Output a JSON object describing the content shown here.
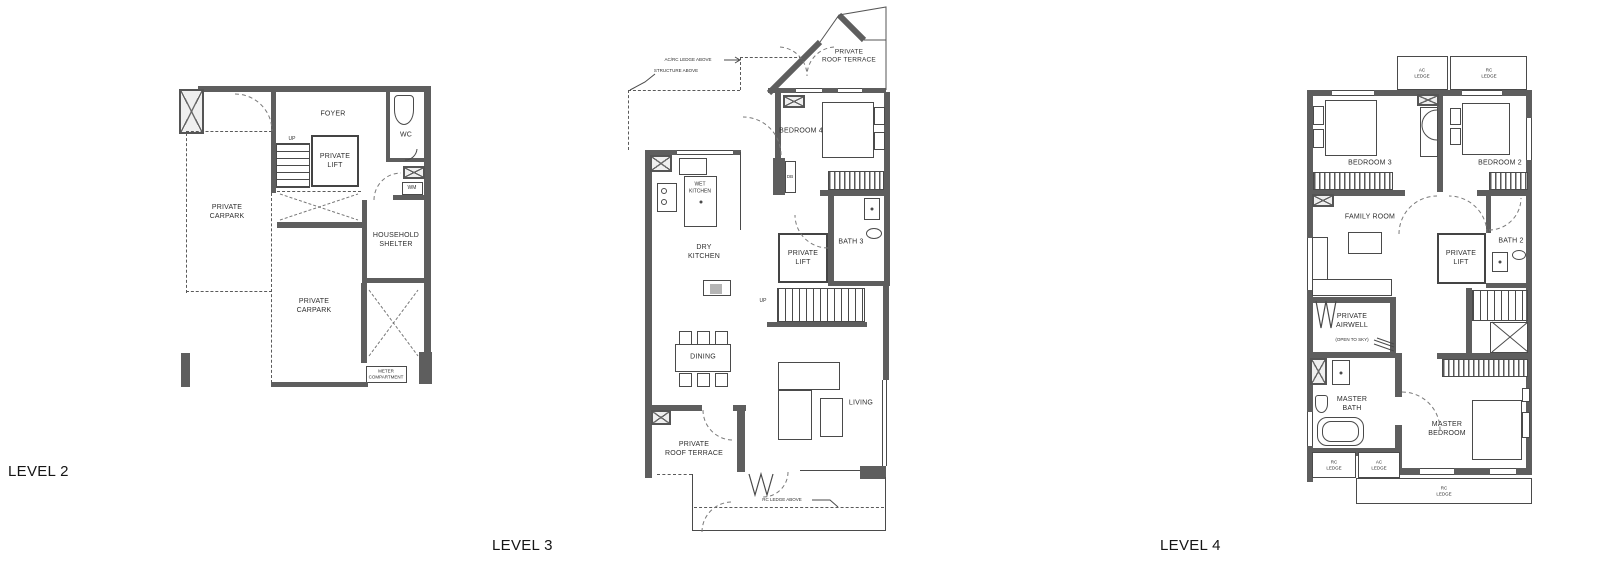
{
  "titles": {
    "level2": "LEVEL 2",
    "level3": "LEVEL 3",
    "level4": "LEVEL 4"
  },
  "level2": {
    "foyer": "FOYER",
    "wc": "WC",
    "private_lift": "PRIVATE\nLIFT",
    "up": "UP",
    "wm": "WM",
    "carpark_upper": "PRIVATE\nCARPARK",
    "household_shelter": "HOUSEHOLD\nSHELTER",
    "carpark_lower": "PRIVATE\nCARPARK",
    "meter": "METER\nCOMPARTMENT"
  },
  "level3": {
    "ledge_note": "AC/RC LEDGE ABOVE",
    "structure_note": "STRUCTURE ABOVE",
    "terrace_top": "PRIVATE\nROOF TERRACE",
    "bedroom4": "BEDROOM 4",
    "db": "DB",
    "wet_kitchen": "WET\nKITCHEN",
    "dry_kitchen": "DRY\nKITCHEN",
    "private_lift": "PRIVATE\nLIFT",
    "bath3": "BATH 3",
    "up": "UP",
    "dining": "DINING",
    "living": "LIVING",
    "terrace_bottom": "PRIVATE\nROOF TERRACE",
    "rc_ledge_note": "RC LEDGE ABOVE"
  },
  "level4": {
    "ac_ledge_top": "AC\nLEDGE",
    "rc_ledge_top": "RC\nLEDGE",
    "bedroom3": "BEDROOM 3",
    "bedroom2": "BEDROOM 2",
    "family_room": "FAMILY ROOM",
    "private_lift": "PRIVATE\nLIFT",
    "bath2": "BATH 2",
    "airwell": "PRIVATE\nAIRWELL",
    "open_to_sky": "(OPEN TO SKY)",
    "master_bath": "MASTER\nBATH",
    "master_bedroom": "MASTER\nBEDROOM",
    "rc_ledge_small": "RC\nLEDGE",
    "ac_ledge_small": "AC\nLEDGE",
    "rc_ledge_bottom": "RC\nLEDGE"
  }
}
